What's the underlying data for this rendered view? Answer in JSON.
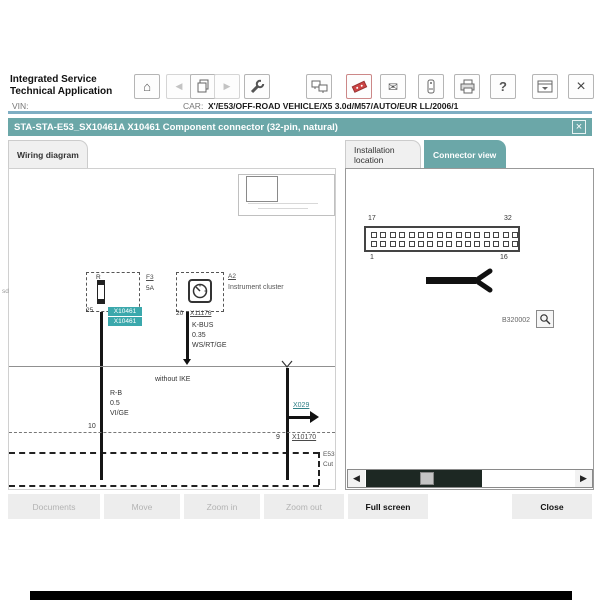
{
  "header": {
    "app_title_line1": "Integrated Service",
    "app_title_line2": "Technical Application",
    "vin_label": "VIN:",
    "car_label": "CAR:",
    "car_value": "X'/E53/OFF-ROAD VEHICLE/X5 3.0d/M57/AUTO/EUR LL/2006/1",
    "icons": {
      "home_glyph": "⌂",
      "back_glyph": "◀",
      "forward_glyph": "▶",
      "mail_glyph": "✉",
      "help_glyph": "?",
      "close_glyph": "×"
    }
  },
  "dialog": {
    "title": "STA-STA-E53_SX10461A X10461 Component connector (32-pin, natural)",
    "close_glyph": "×"
  },
  "tabs": [
    {
      "label": "Wiring diagram",
      "active": false
    },
    {
      "label": "Installation location",
      "active": false
    },
    {
      "label": "Connector view",
      "active": true
    }
  ],
  "wiring_diagram": {
    "margin_note": "sd",
    "fuse": {
      "designation": "R",
      "ref": "F3",
      "rating": "5A",
      "pin": "25",
      "connector_chip_top": "X10461",
      "connector_chip_bottom": "X10461"
    },
    "instrument_cluster": {
      "ref": "A2",
      "label": "Instrument cluster",
      "pin": "20",
      "connector": "X11176",
      "wire_bus": "K-BUS",
      "wire_gauge": "0.35",
      "wire_color": "WS/RT/GE"
    },
    "left_wire": {
      "circuit": "R-B",
      "gauge": "0.5",
      "color": "VI/GE"
    },
    "branch_note": "without IKE",
    "links": {
      "x029": "X029",
      "x10170": "X10170"
    },
    "pins": {
      "left": "10",
      "right": "9"
    },
    "ground_labels": {
      "line1": "E53",
      "line2": "Cut"
    }
  },
  "connector_view": {
    "pin_rows": 2,
    "pin_cols": 16,
    "corner_labels": {
      "top_left": "17",
      "top_right": "32",
      "bottom_left": "1",
      "bottom_right": "16"
    },
    "figure_id": "B320002",
    "scroll_left_glyph": "◀",
    "scroll_right_glyph": "▶"
  },
  "footer": {
    "buttons": [
      {
        "label": "Documents",
        "enabled": false
      },
      {
        "label": "Move",
        "enabled": false
      },
      {
        "label": "Zoom in",
        "enabled": false
      },
      {
        "label": "Zoom out",
        "enabled": false
      },
      {
        "label": "Full screen",
        "enabled": true
      },
      {
        "label": "Close",
        "enabled": true
      }
    ]
  },
  "colors": {
    "teal": "#6BA7A8",
    "chip_teal": "#3BA8AC",
    "divider_blue": "#7FAEC3",
    "scrollbar_dark": "#1d2823"
  }
}
